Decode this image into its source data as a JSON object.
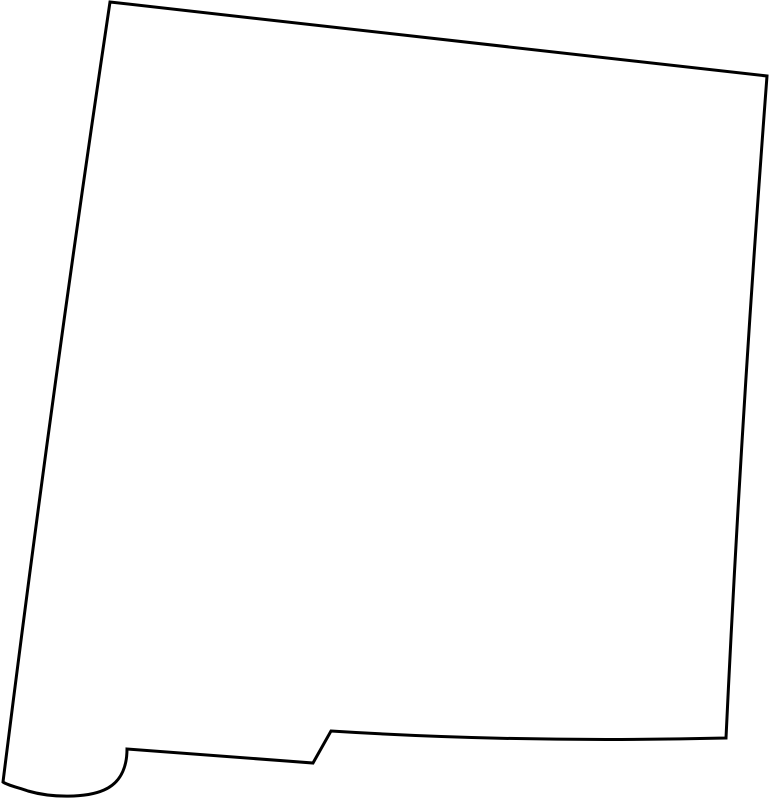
{
  "page": {
    "background_color": "#ffffff"
  },
  "map": {
    "region_name": "New Mexico",
    "kind": "state-outline",
    "stroke_color": "#000000",
    "fill_color": "#ffffff",
    "stroke_width": "3",
    "path": "M 110 2 L 767 76 Q 741 420 726 738 Q 520 743 331 731 L 313 763 L 127 749 C 127 768 120 783 104 790 C 86 798 52 798 28 791 C 16 787 7 785 3 782 Q 52 390 110 2 Z"
  }
}
